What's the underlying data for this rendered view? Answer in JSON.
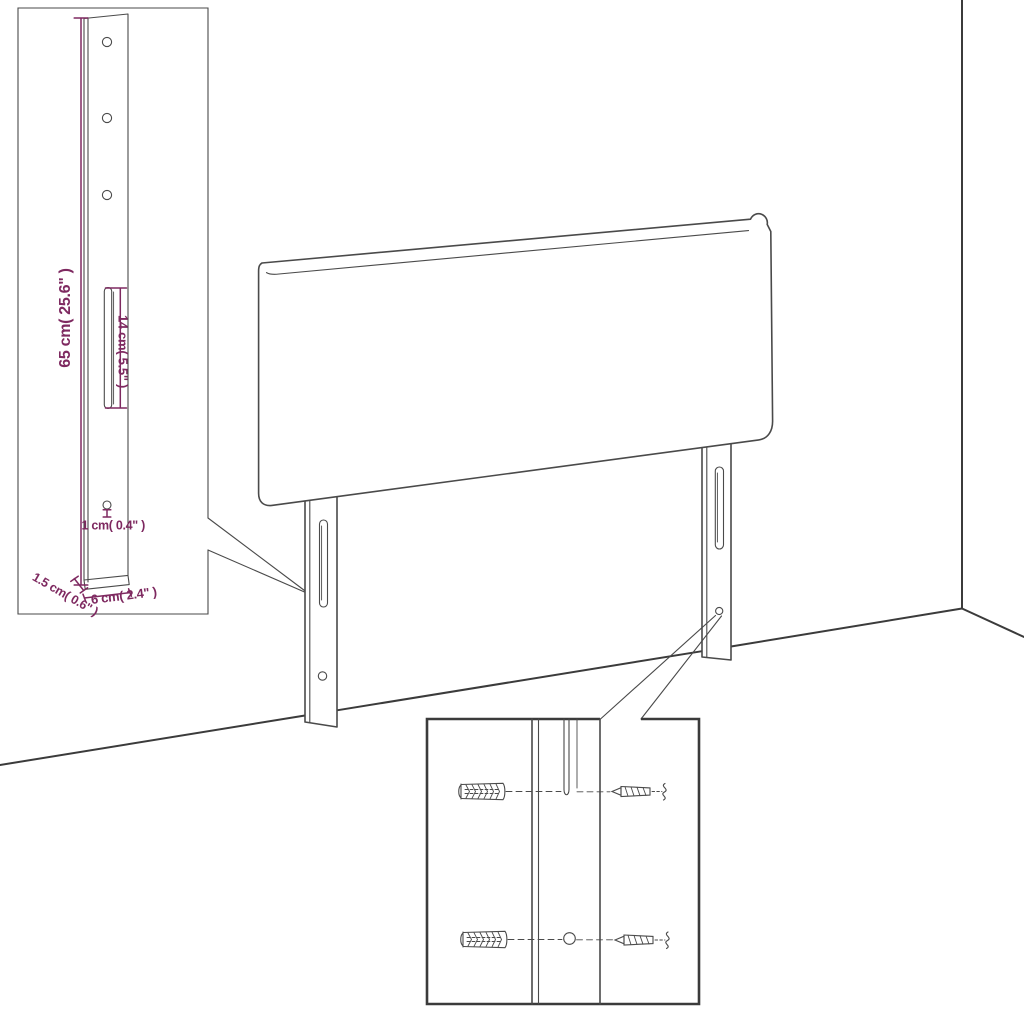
{
  "image": {
    "background": "#ffffff"
  },
  "colors": {
    "line": "#4a4a4a",
    "line-bold": "#3b3b3b",
    "dim": "#7e2960"
  },
  "insets": {
    "leg_detail": {
      "labels": {
        "height": "65 cm( 25.6\" )",
        "slot": "14 cm( 5.5\" )",
        "hole": "1 cm( 0.4\" )",
        "depth": "1.5 cm( 0.6\" )",
        "width": "6 cm( 2.4\" )"
      }
    },
    "mounting_detail": {
      "icons": {
        "wall_plug": "wall-plug-icon",
        "screw": "screw-icon"
      }
    }
  }
}
